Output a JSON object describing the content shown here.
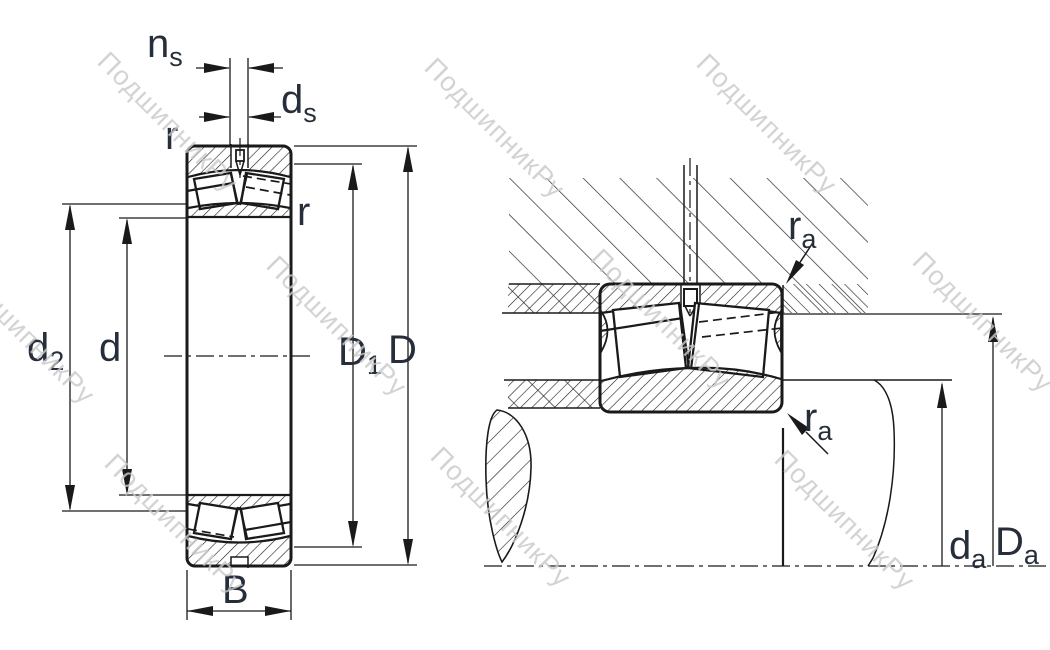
{
  "watermark": {
    "text": "ПодшипникРу",
    "color": "#c9c9c9"
  },
  "colors": {
    "label": "#262e3a",
    "line": "#1a1a1a",
    "background": "#ffffff"
  },
  "left_figure": {
    "name": "bearing cross-section",
    "labels": {
      "ns": {
        "base": "n",
        "sub": "s"
      },
      "ds": {
        "base": "d",
        "sub": "s"
      },
      "r_top_left": "r",
      "r_right": "r",
      "d2": {
        "base": "d",
        "sub": "2"
      },
      "d": "d",
      "D1": {
        "base": "D",
        "sub": "1"
      },
      "D": "D",
      "B": "B"
    }
  },
  "right_figure": {
    "name": "mounting abutment drawing",
    "labels": {
      "ra_upper": {
        "base": "r",
        "sub": "a"
      },
      "ra_lower": {
        "base": "r",
        "sub": "a"
      },
      "da": {
        "base": "d",
        "sub": "a"
      },
      "Da": {
        "base": "D",
        "sub": "a"
      }
    }
  }
}
